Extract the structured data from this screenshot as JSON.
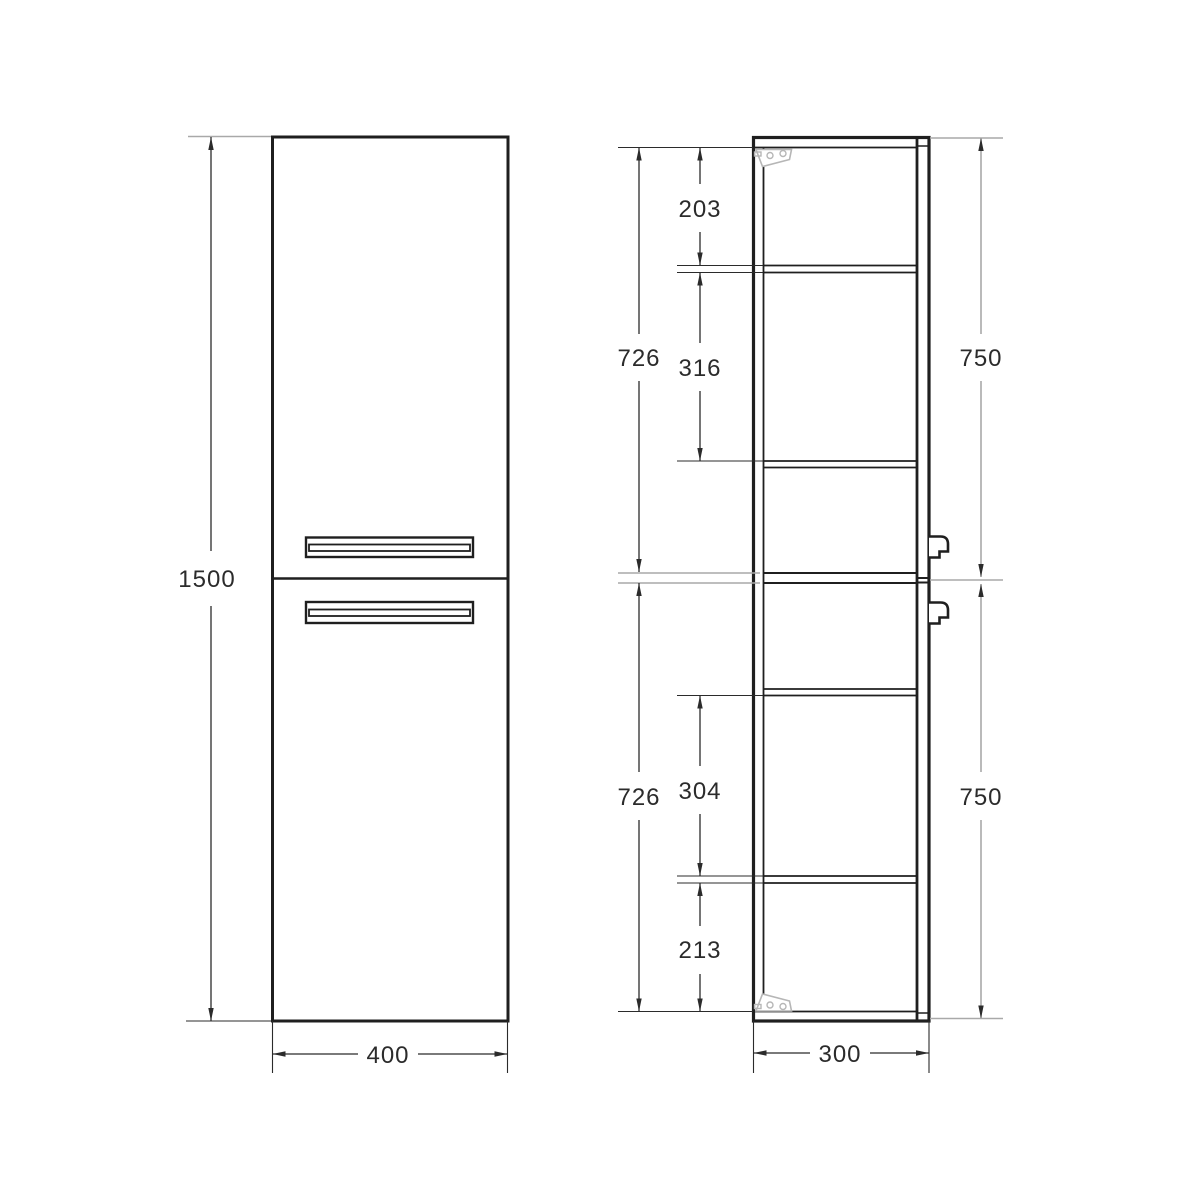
{
  "drawing": {
    "front_view": {
      "height": "1500",
      "width": "400"
    },
    "side_view": {
      "depth": "300",
      "upper": {
        "interior": "726",
        "top_shelf_gap": "203",
        "shelf_gap": "316",
        "door": "750"
      },
      "lower": {
        "interior": "726",
        "shelf_gap": "304",
        "bottom_gap": "213",
        "door": "750"
      }
    }
  },
  "colors": {
    "background": "#ffffff",
    "line": "#1f1f1f",
    "dim": "#2b2b2b",
    "ext-gray": "#a9a9a9",
    "hinge-gray": "#b6b6b6",
    "text": "#2b2b2b"
  }
}
